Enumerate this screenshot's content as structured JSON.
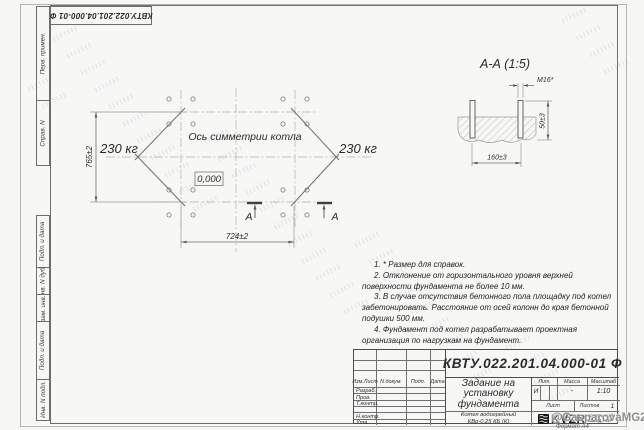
{
  "sheet": {
    "doc_number_top": "КВТУ.022.201.04.000-01 Ф",
    "watermark": "@GasparovaMG2021",
    "format_label": "Формат А4"
  },
  "margin_fields": {
    "perv_primen": "Перв. примен.",
    "sprav_n": "Справ. N",
    "podp_data_1": "Подп. и дата",
    "inv_n_dubl": "Инв. N дубл.",
    "vzam_inv_n": "Взам. инв. N",
    "podp_data_2": "Подп. и дата",
    "inv_n_podl": "Инв. N подл."
  },
  "plan": {
    "axis_label": "Ось симметрии котла",
    "load_left": "230 кг",
    "load_right": "230 кг",
    "level_mark": "0,000",
    "dim_width": "724±2",
    "dim_height": "765±2",
    "section_letter_left": "А",
    "section_letter_right": "А"
  },
  "section_view": {
    "title": "А-А  (1:5)",
    "thread_label": "М16*",
    "dim_span": "160±3",
    "dim_height": "50±3"
  },
  "notes": {
    "lines": [
      "1. * Размер для справок.",
      "2. Отклонение от горизонтального уровня верхней поверхности фундамента не более 10 мм.",
      "3. В случае отсутствия бетонного пола площадку под котел забетонировать. Расстояние от осей колонн до края бетонной подушки 500 мм.",
      "4. Фундамент под котел разрабатывает проектная организация по нагрузкам на фундамент."
    ]
  },
  "title_block": {
    "doc_number": "КВТУ.022.201.04.000-01 Ф",
    "title_lines": [
      "Задание на",
      "установку",
      "фундамента"
    ],
    "product_lines": [
      "Котел водогрейный",
      "КВр-0,25 КБ  (К)"
    ],
    "cols": {
      "izm": "Изм.Лист",
      "ndoc": "N докум.",
      "podp": "Подп.",
      "data": "Дата"
    },
    "row_labels": [
      "Разраб.",
      "Пров.",
      "Т.контр.",
      "Н.контр.",
      "Утв."
    ],
    "lit_label": "Лит.",
    "lit_value": "И",
    "mass_label": "Масса",
    "mass_value": "-",
    "scale_label": "Масштаб",
    "scale_value": "1:10",
    "sheet_label": "Лист",
    "sheets_label": "Листов",
    "sheets_value": "1",
    "logo_text": "KVZR",
    "logo_sub": [
      "КОТЕЛЬНЫЙ",
      "ЗАВОД РЭП"
    ]
  }
}
